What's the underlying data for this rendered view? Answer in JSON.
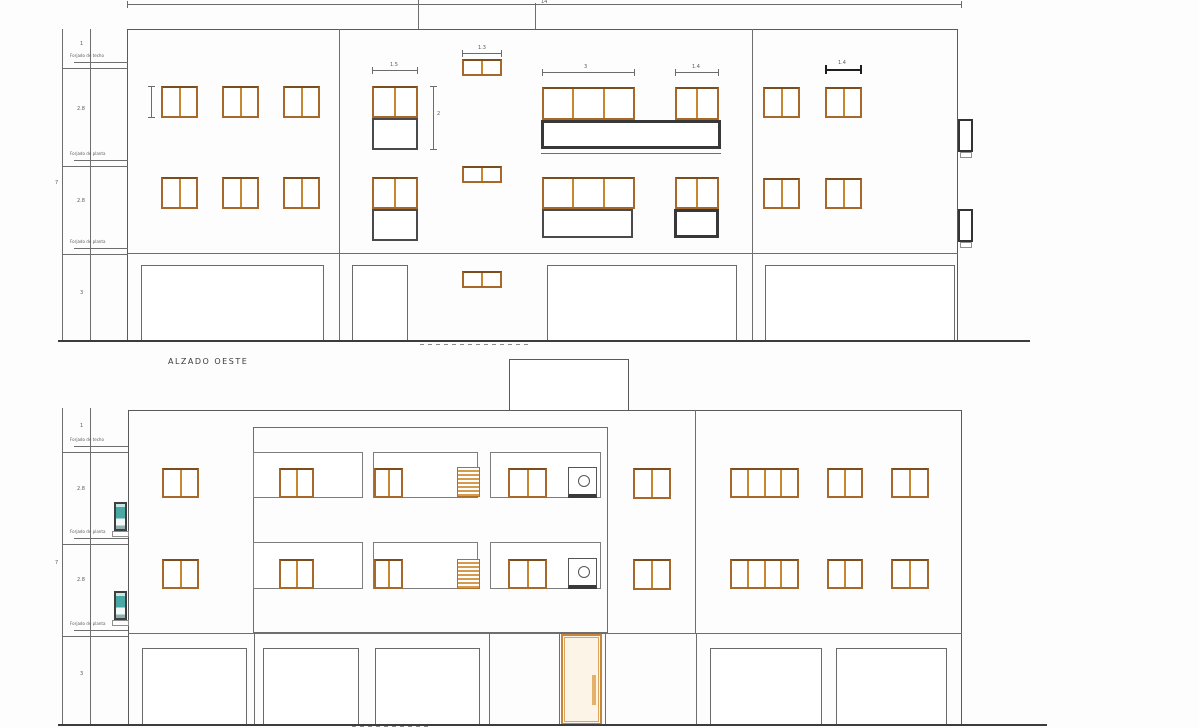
{
  "colors": {
    "window_frame": "#a8682a",
    "window_mullion": "#c8862f",
    "dark_outline": "#3c3c3c",
    "drawing_line": "#6e6e6e",
    "teal_glass": "#49a8a3",
    "door_frame": "#c8863b",
    "louver_orange": "#d69a4e",
    "background": "#fdfdfd"
  },
  "elev1": {
    "title": "ALZADO OESTE",
    "left_dims": {
      "overall": "7",
      "heights": [
        "1",
        "2.8",
        "2.8",
        "3"
      ],
      "slab_labels": [
        "Forjado de techo",
        "Forjado de planta",
        "Forjado de planta"
      ]
    },
    "dim_labels": {
      "top": "14",
      "unit_width": "1.5",
      "unit_height": "2",
      "stair_window": "1.3",
      "window_3pane": "3",
      "window_2pane": "1.4",
      "right_window": "1.4"
    }
  },
  "elev2": {
    "left_dims": {
      "overall": "7",
      "heights": [
        "1",
        "2.8",
        "2.8",
        "3"
      ],
      "slab_labels": [
        "Forjado de techo",
        "Forjado de planta",
        "Forjado de planta"
      ]
    }
  }
}
